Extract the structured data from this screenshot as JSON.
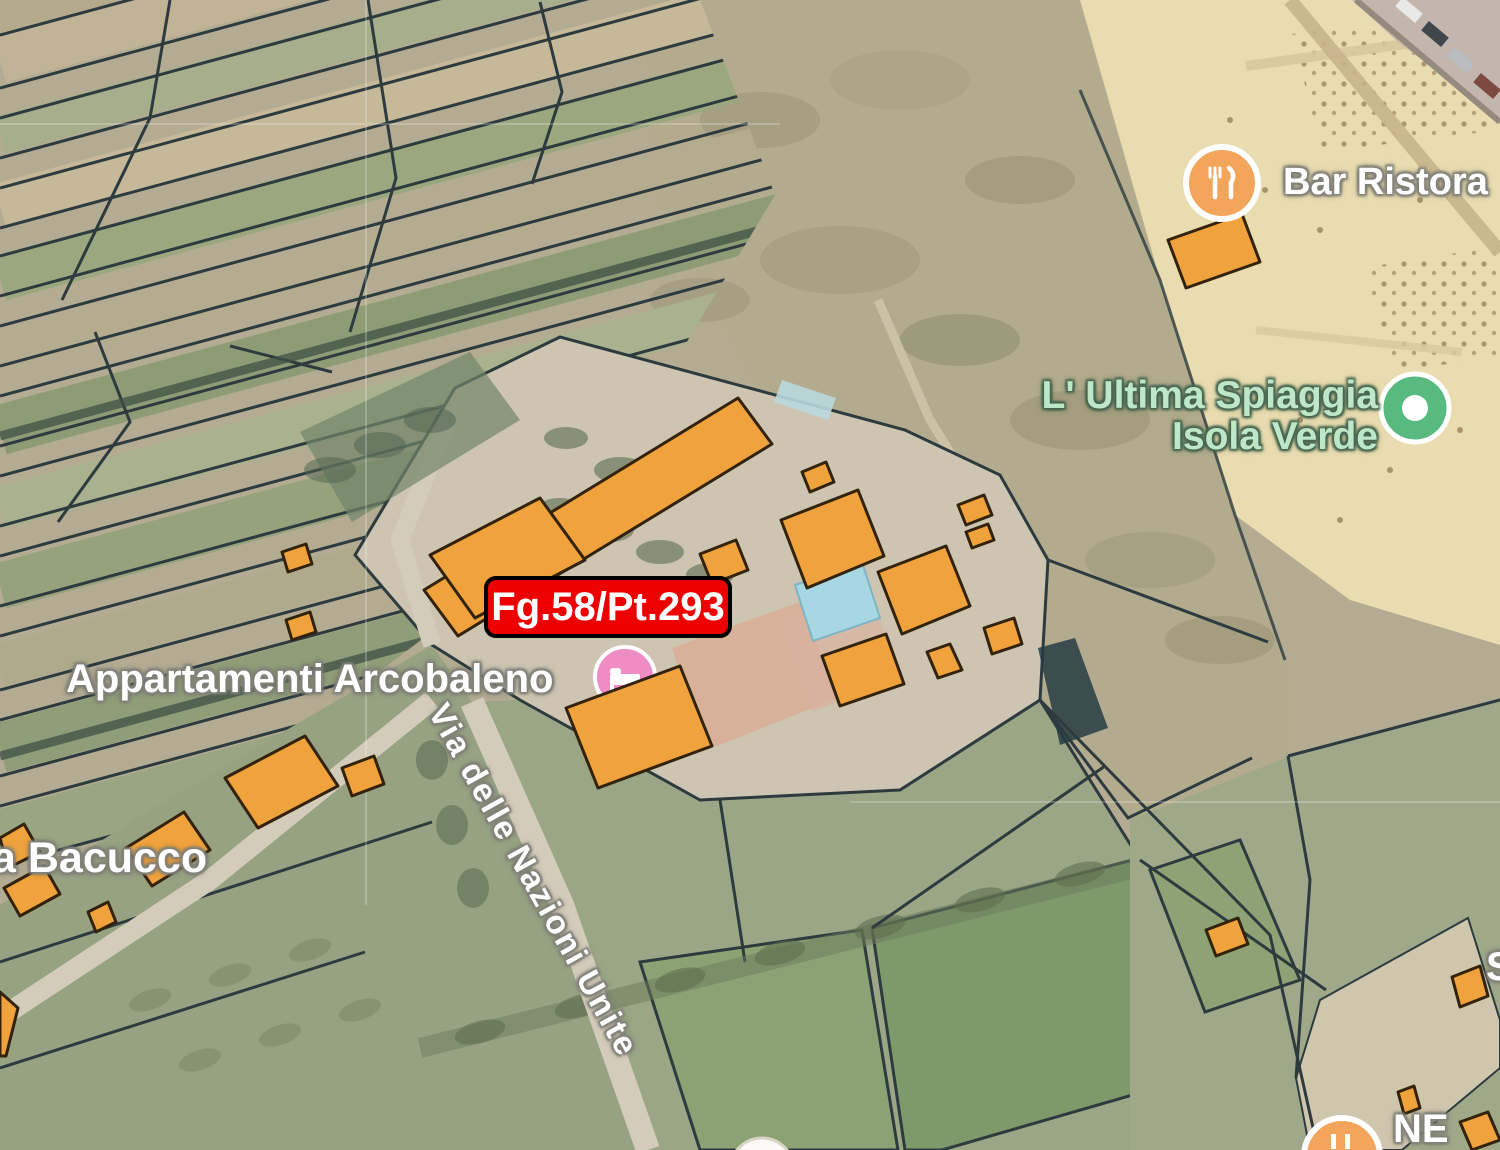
{
  "map": {
    "kind": "satellite-cadastral-view",
    "badge": {
      "text": "Fg.58/Pt.293"
    },
    "pois": [
      {
        "id": "bar-ristorante",
        "label": "Bar Ristora",
        "icon": "restaurant-icon"
      },
      {
        "id": "ultima-spiaggia",
        "label_line1": "L' Ultima Spiaggia",
        "label_line2": "Isola Verde",
        "icon": "green-dot-poi-icon"
      },
      {
        "id": "appartamenti-arcobaleno",
        "label": "Appartamenti Arcobaleno",
        "icon": "lodging-icon"
      },
      {
        "id": "bottom-right-partial",
        "label": "NE",
        "icon": "restaurant-icon"
      },
      {
        "id": "right-edge-partial",
        "label": "S",
        "icon": ""
      }
    ],
    "street_labels": [
      {
        "id": "via-delle-nazioni-unite",
        "text": "Via delle Nazioni Unite"
      },
      {
        "id": "via-bacucco",
        "text": "a Bacucco"
      }
    ]
  },
  "colors": {
    "building_orange": "#f0a23c",
    "building_outline": "#33230a",
    "parcel_line": "#2d3b3e",
    "badge_bg": "#ec0000",
    "badge_border": "#000000",
    "badge_text": "#ffffff",
    "pool_blue": "#a6d7e3",
    "poi_pink": "#ef8cc4",
    "poi_green": "#58ba7f",
    "poi_orange": "#f3a65b",
    "label_white": "#ffffff",
    "label_outline": "#82827a",
    "label_green": "#bde7c6",
    "label_green_outline": "#47664f",
    "sand": "#e9dcb0",
    "road_light": "#d4ccba"
  }
}
